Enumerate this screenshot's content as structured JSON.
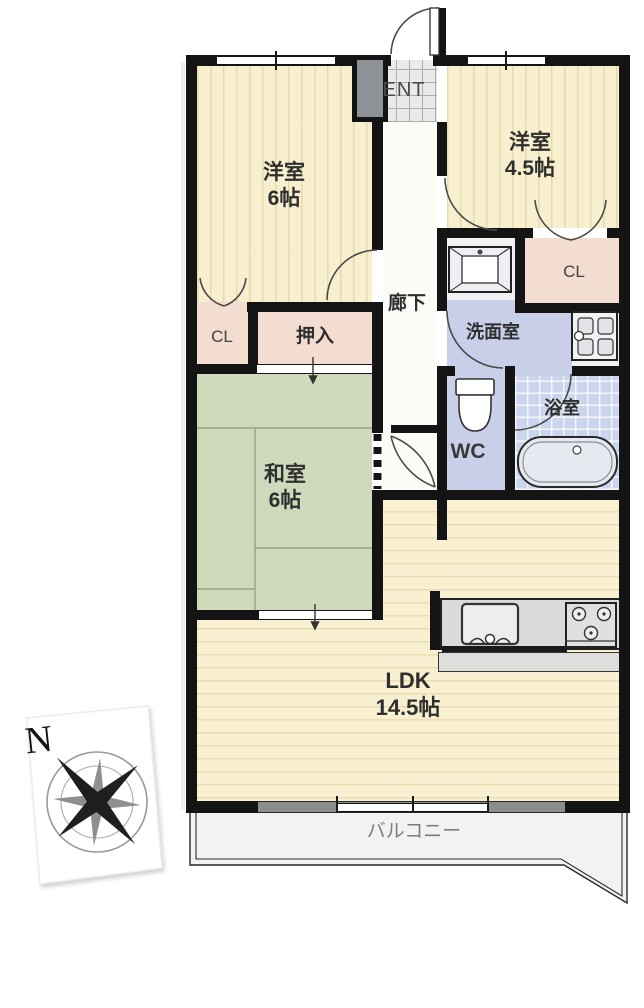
{
  "plan": {
    "rooms": {
      "western6": {
        "name": "洋室",
        "size": "6帖"
      },
      "western45": {
        "name": "洋室",
        "size": "4.5帖"
      },
      "japanese6": {
        "name": "和室",
        "size": "6帖"
      },
      "ldk": {
        "name": "LDK",
        "size": "14.5帖"
      },
      "entrance_label": "ENT",
      "corridor_label": "廊下",
      "washroom_label": "洗面室",
      "wc_label": "WC",
      "bath_label": "浴室",
      "closet_left_label": "CL",
      "closet_right_label": "CL",
      "oshiire_label": "押入",
      "balcony_label": "バルコニー"
    },
    "compass": {
      "north_label": "N"
    },
    "colors": {
      "wall": "#141414",
      "western_room_fill": "#f7efcd",
      "japanese_room_fill": "#cfdabd",
      "ldk_fill": "#f8f0d0",
      "closet_fill": "#f3dcd0",
      "water_area_fill": "#c9cfe9",
      "bath_tile_fill": "#ccd5ee",
      "entrance_tile_fill": "#e9ebe9",
      "counter_fill": "#d9dcd9",
      "balcony_fill": "#f0f3f0",
      "shoe_cabinet_fill": "#8e9296"
    },
    "icons": {
      "compass_rose": "compass-rose-icon",
      "bathtub": "bathtub-icon",
      "toilet": "toilet-icon",
      "vanity": "vanity-sink-icon",
      "washer_pan": "washing-machine-pan-icon",
      "kitchen_sink": "kitchen-sink-icon",
      "stove": "stove-burners-icon",
      "shoe_cabinet": "shoe-cabinet-icon"
    }
  }
}
